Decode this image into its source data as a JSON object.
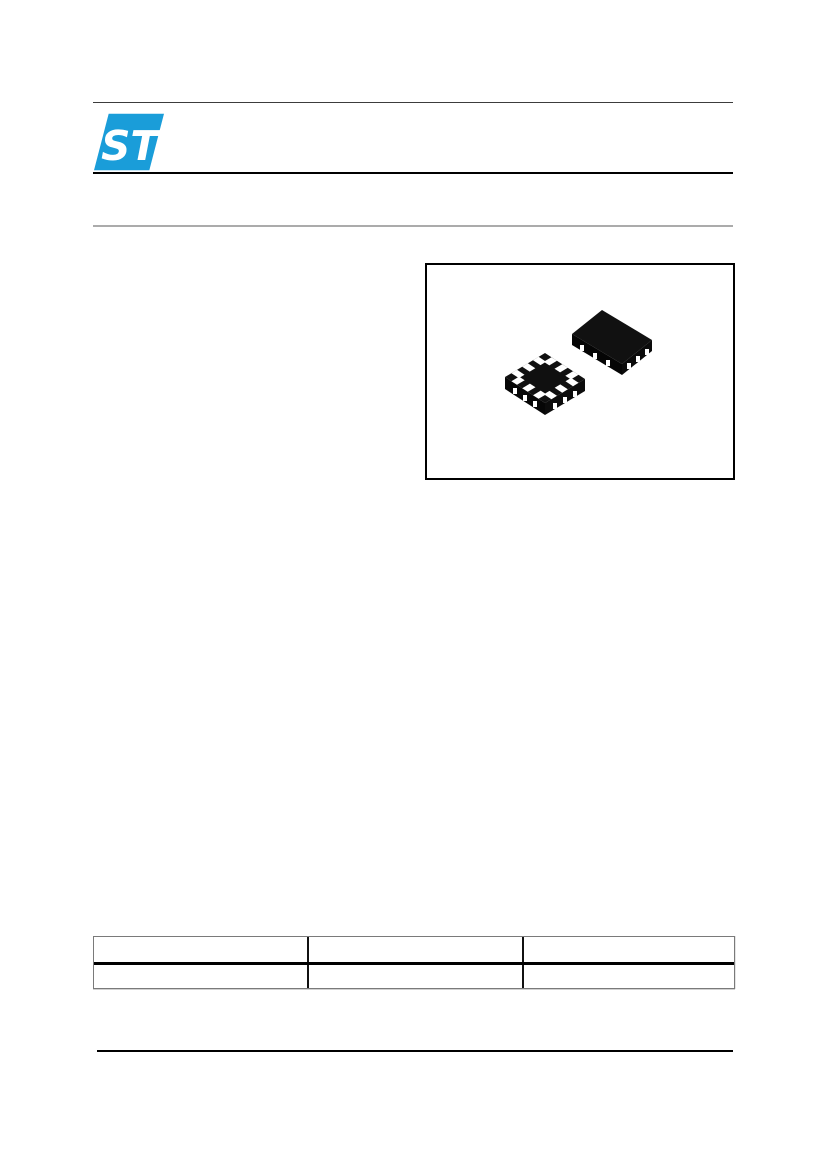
{
  "page": {
    "kind": "datasheet-first-page",
    "background": "#ffffff"
  },
  "header": {
    "logo_text": "ST",
    "logo_color": "#1a9dd9"
  },
  "figure": {
    "images": [
      "qfn-package-bottom-view",
      "qfn-package-top-view"
    ],
    "chip_color": "#0e0e0e",
    "pad_color": "#ffffff"
  },
  "table": {
    "headers": [
      "",
      "",
      ""
    ],
    "rows": [
      [
        "",
        "",
        ""
      ]
    ]
  },
  "rules": {
    "top_color": "#3c3c3c",
    "header_color": "#000000",
    "subheader_color": "#ababab",
    "footer_color": "#000000"
  }
}
